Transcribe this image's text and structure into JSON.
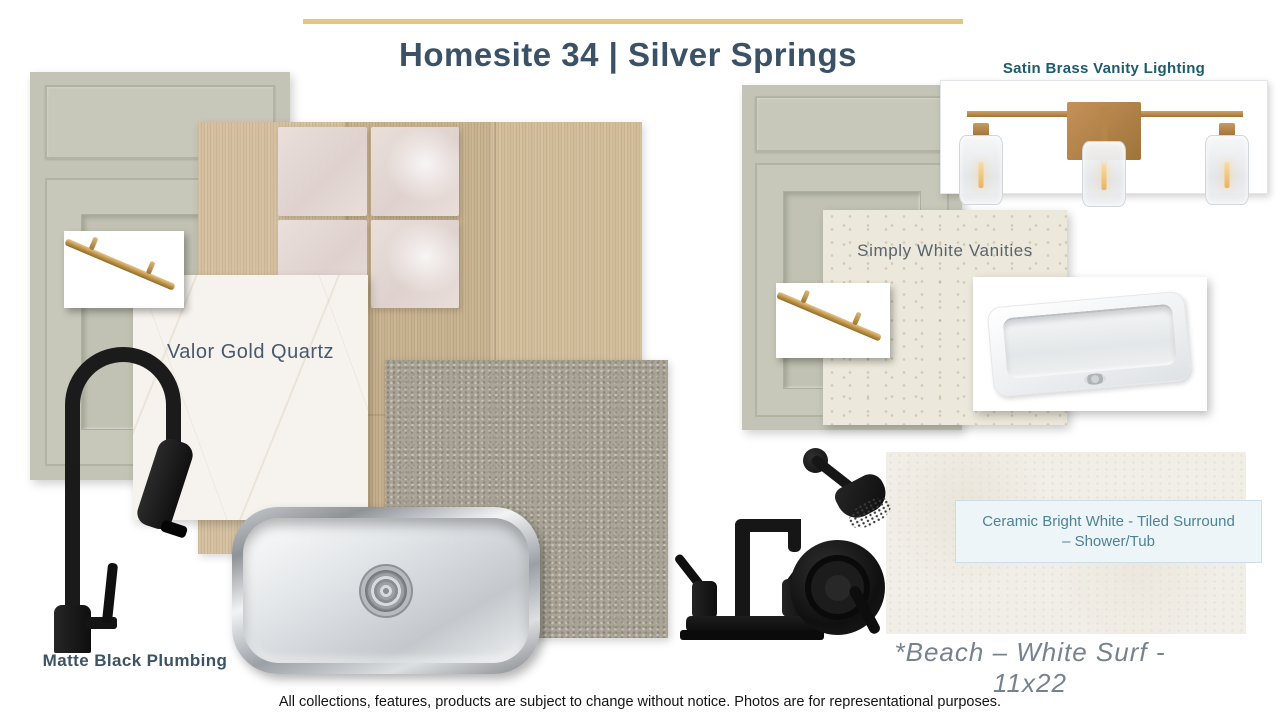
{
  "header": {
    "title": "Homesite 34 | Silver Springs"
  },
  "products": {
    "vanity_lighting": {
      "label": "Satin Brass Vanity Lighting",
      "image": "brass-3-light-vanity-fixture"
    },
    "quartz": {
      "label": "Valor Gold Quartz",
      "image": "white-marble-quartz-swatch"
    },
    "vanities": {
      "label": "Simply White Vanities",
      "image": "cream-speckled-quartz-swatch"
    },
    "plumbing": {
      "label": "Matte Black Plumbing",
      "image": "matte-black-faucets-and-shower"
    },
    "shower_tile": {
      "label": "Ceramic Bright White - Tiled Surround – Shower/Tub",
      "image": "off-white-ceramic-tile-swatch"
    },
    "floor_tile": {
      "label": "*Beach – White Surf - 11x22",
      "image": "glossy-white-square-tiles"
    },
    "cabinet": {
      "image": "sage-green-shaker-cabinet-door"
    },
    "hardware": {
      "image": "satin-brass-bar-pull"
    },
    "kitchen_sink": {
      "image": "stainless-steel-undermount-sink"
    },
    "bath_sink": {
      "image": "white-rectangular-undermount-sink"
    },
    "flooring": {
      "image": "light-oak-plank-flooring"
    },
    "carpet": {
      "image": "beige-textured-carpet"
    }
  },
  "footer": {
    "disclaimer": "All collections, features, products are subject to change without notice.  Photos are for representational purposes."
  },
  "colors": {
    "accent_gold": "#E4C77F",
    "title_blue": "#3B5266",
    "teal_heading": "#1E5B6D",
    "teal_label": "#4E8296",
    "cabinet_sage": "#C3C4B5",
    "beach_gray": "#76828F"
  }
}
